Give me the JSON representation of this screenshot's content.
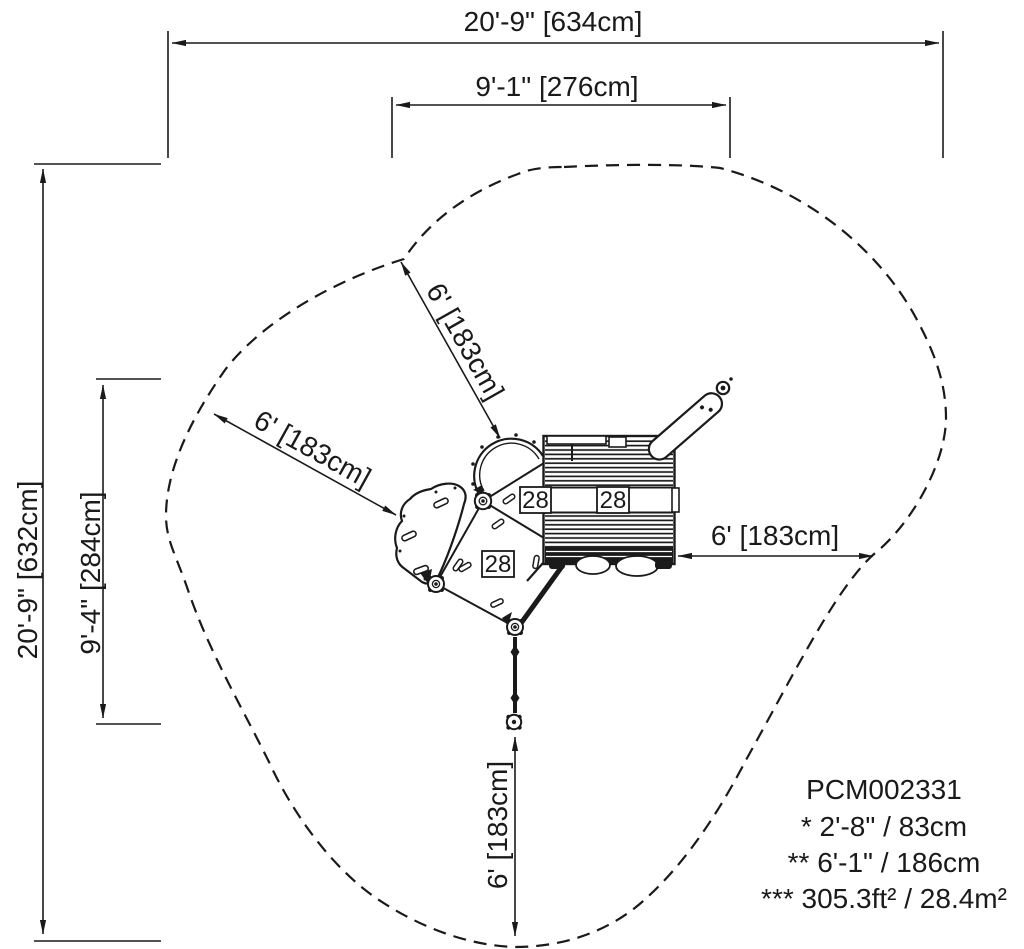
{
  "dimensions": {
    "overall_width": "20'-9\" [634cm]",
    "inner_width": "9'-1\" [276cm]",
    "overall_height": "20'-9\" [632cm]",
    "inner_height": "9'-4\" [284cm]",
    "clearance_upper": "6' [183cm]",
    "clearance_left": "6' [183cm]",
    "clearance_right": "6' [183cm]",
    "clearance_bottom": "6' [183cm]"
  },
  "part_labels": {
    "left": "28",
    "center": "28",
    "lower": "28"
  },
  "notes": {
    "model": "PCM002331",
    "line1": "* 2'-8\" / 83cm",
    "line2": "** 6'-1\" / 186cm",
    "line3": "*** 305.3ft² / 28.4m²"
  },
  "colors": {
    "ink": "#1a1a1a",
    "paper": "#ffffff"
  }
}
